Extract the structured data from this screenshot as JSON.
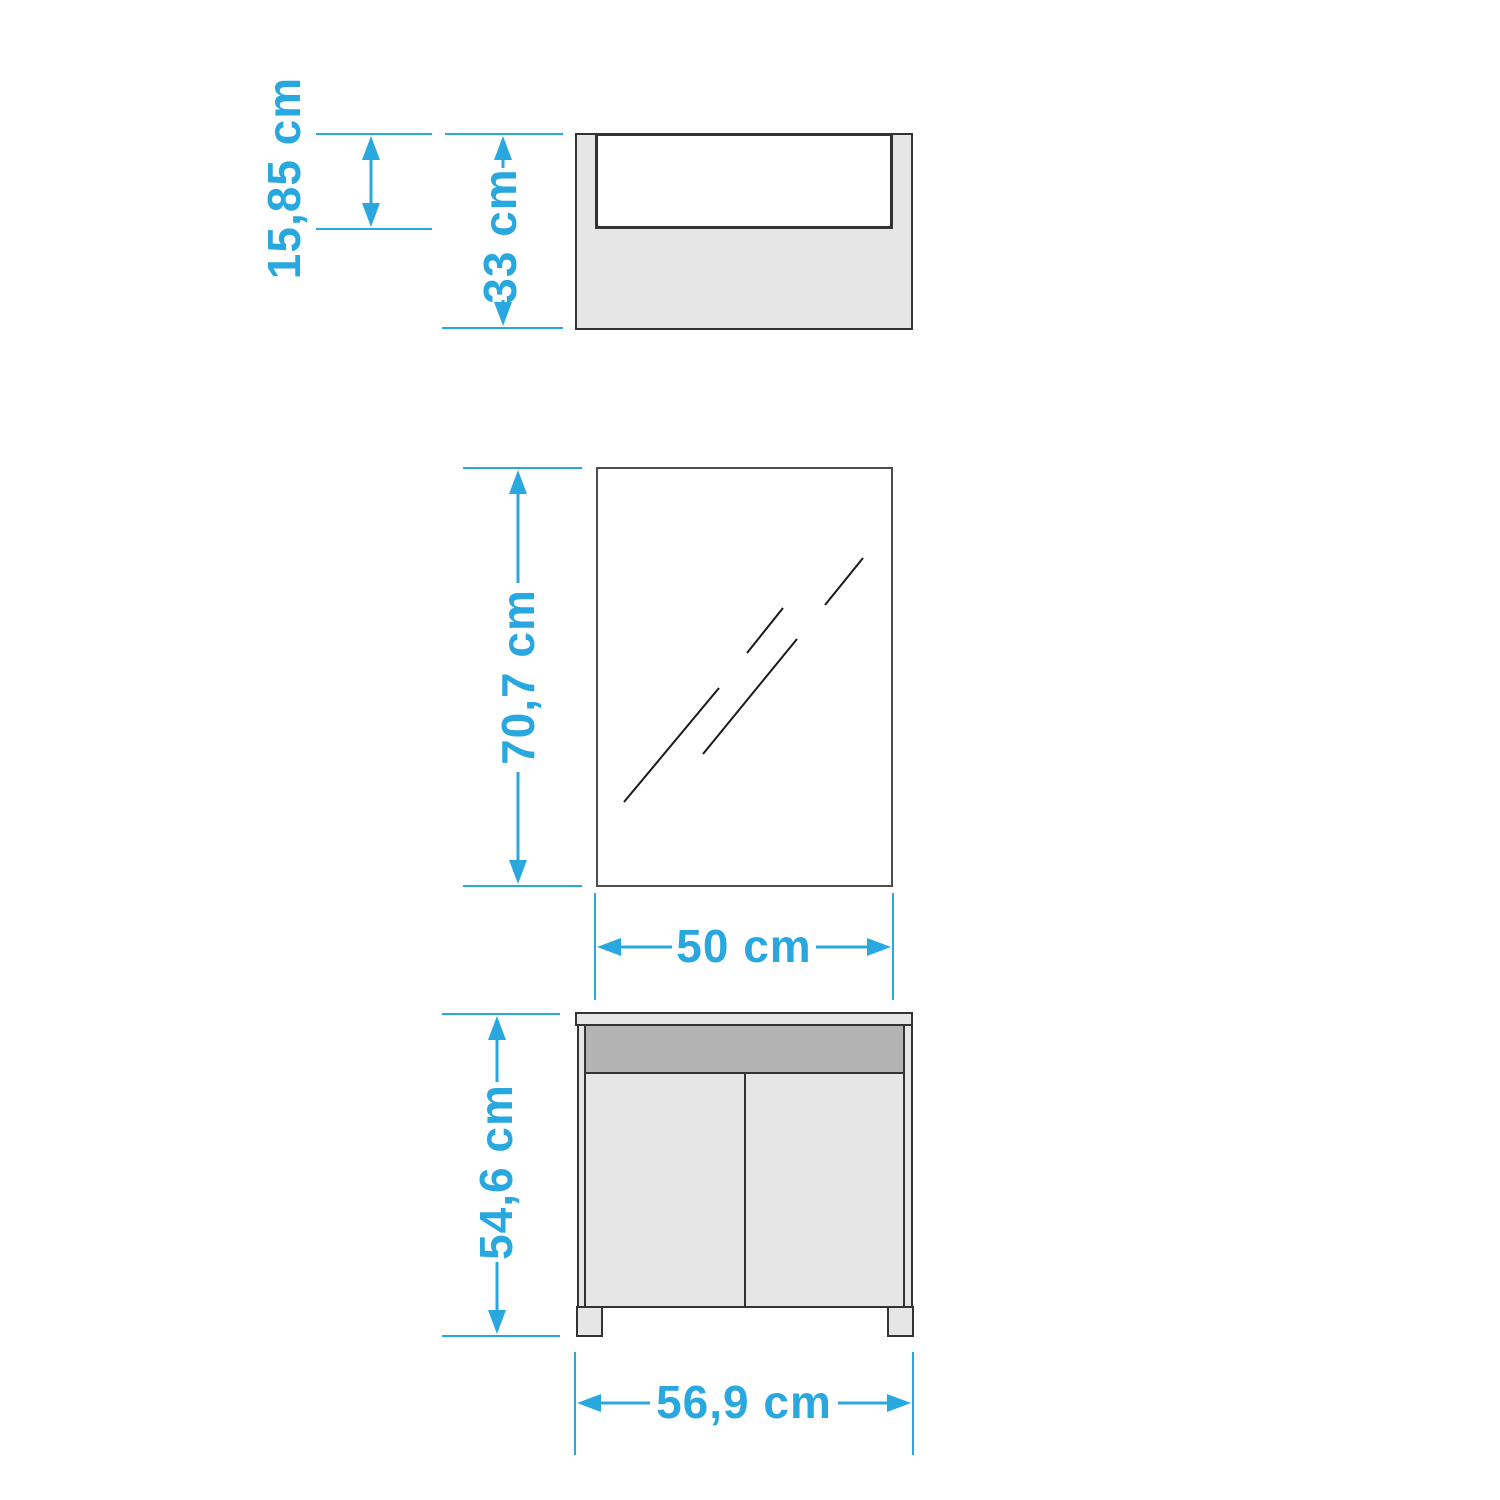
{
  "drawing": {
    "title": "furniture-dimension-drawing",
    "unit": "cm",
    "colors": {
      "dimension_accent": "#29a8e0",
      "outline": "#333333",
      "fill_light": "#e6e6e6",
      "fill_dark": "#b3b3b3",
      "fill_white": "#ffffff"
    },
    "shelf": {
      "view": "wall-shelf-front-view",
      "opening_height_label": "15,85 cm",
      "height_label": "33 cm"
    },
    "mirror": {
      "view": "mirror-front-view",
      "height_label": "70,7 cm",
      "width_label": "50 cm"
    },
    "vanity": {
      "view": "vanity-cabinet-front-view",
      "height_label": "54,6 cm",
      "width_label": "56,9 cm"
    }
  }
}
